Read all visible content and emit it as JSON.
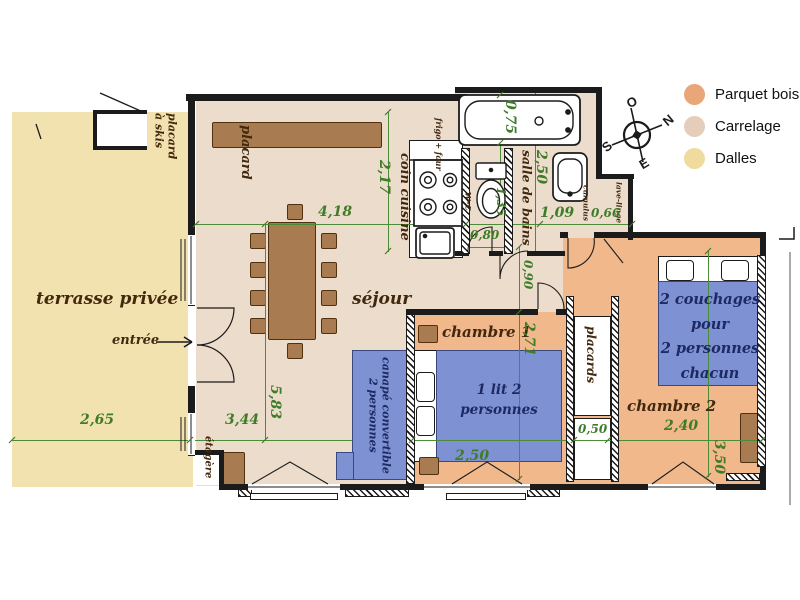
{
  "legend": {
    "items": [
      {
        "label": "Parquet bois",
        "color": "#e8a679"
      },
      {
        "label": "Carrelage",
        "color": "#e6cdbb"
      },
      {
        "label": "Dalles",
        "color": "#f0db9e"
      }
    ]
  },
  "compass": {
    "north": "N",
    "south": "S",
    "east": "E",
    "west": "O"
  },
  "colors": {
    "parquet": "#f1b88b",
    "carrelage": "#ecdccb",
    "dalles": "#f2e2af",
    "bed_blue": "#7e91d2",
    "bed_text": "#1d2963",
    "furniture": "#a87c50",
    "dimension_green": "#3e7c28",
    "label_brown": "#42280e",
    "wall": "#1b1b1b"
  },
  "rooms": {
    "terrace": "terrasse privée",
    "entry": "entrée",
    "entry_arrow": "→",
    "living": "séjour",
    "kitchen": "coin cuisine",
    "bathroom": "salle de bains",
    "wc": "w-c",
    "bedroom1": "chambre 1",
    "bedroom2": "chambre 2",
    "closet": "placard",
    "closets": "placards",
    "ski_closet": "placard\nà skis",
    "shelf": "étagère",
    "fridge_oven": "frigo + four",
    "washing_machine": "lave-linge",
    "water_heater": "cumulus"
  },
  "furniture": {
    "bed1": "1 lit 2\npersonnes",
    "sofa": "canapé convertible\n2 personnes",
    "bed2": "2 couchages\npour\n2 personnes\nchacun"
  },
  "dimensions": {
    "living_width": "4,18",
    "kitchen_length": "2,17",
    "bathtub_width": "0,75",
    "bath_length": "2,50",
    "bath_inner": "1,35",
    "wc_width": "0,80",
    "hall_top": "1,09",
    "niche_width": "0,66",
    "hall_width": "0,90",
    "bedroom1_length": "2,71",
    "bedroom1_width": "2,50",
    "closet_depth": "0,50",
    "bedroom2_width": "2,40",
    "bedroom2_length": "3,50",
    "living_length": "5,83",
    "terrace_width": "2,65",
    "living_left_width": "3,44"
  }
}
